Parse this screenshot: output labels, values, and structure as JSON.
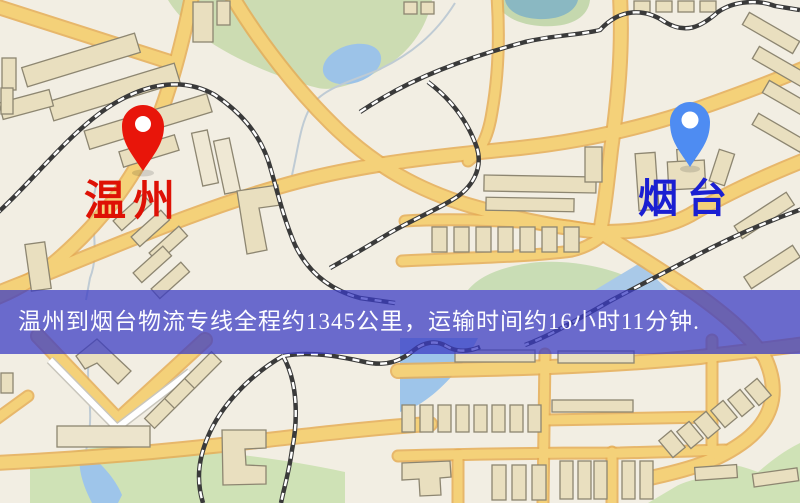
{
  "page": {
    "width": 800,
    "height": 503,
    "kind": "logistics-route-map"
  },
  "markers": {
    "origin": {
      "label": "温州",
      "pin_color": "#e8150a",
      "label_color": "#de1105"
    },
    "destination": {
      "label": "烟台",
      "pin_color": "#4e8cf2",
      "label_color": "#1a1fd2"
    }
  },
  "banner": {
    "text": "温州到烟台物流专线全程约1345公里，运输时间约16小时11分钟.",
    "route_distance": "约1345公里",
    "route_duration": "约16小时11分钟",
    "background_color": "#3a3cc3",
    "text_color": "#ffffff"
  },
  "map": {
    "colors": {
      "background": "#f2eee3",
      "road_fill": "#f4d179",
      "road_casing": "#e5ad56",
      "park_green": "#cfe0b6",
      "water_blue": "#9ec5ea",
      "building_fill": "#e9dfbf",
      "building_outline": "#8d8671",
      "railway_dark": "#3a3a3a"
    }
  }
}
